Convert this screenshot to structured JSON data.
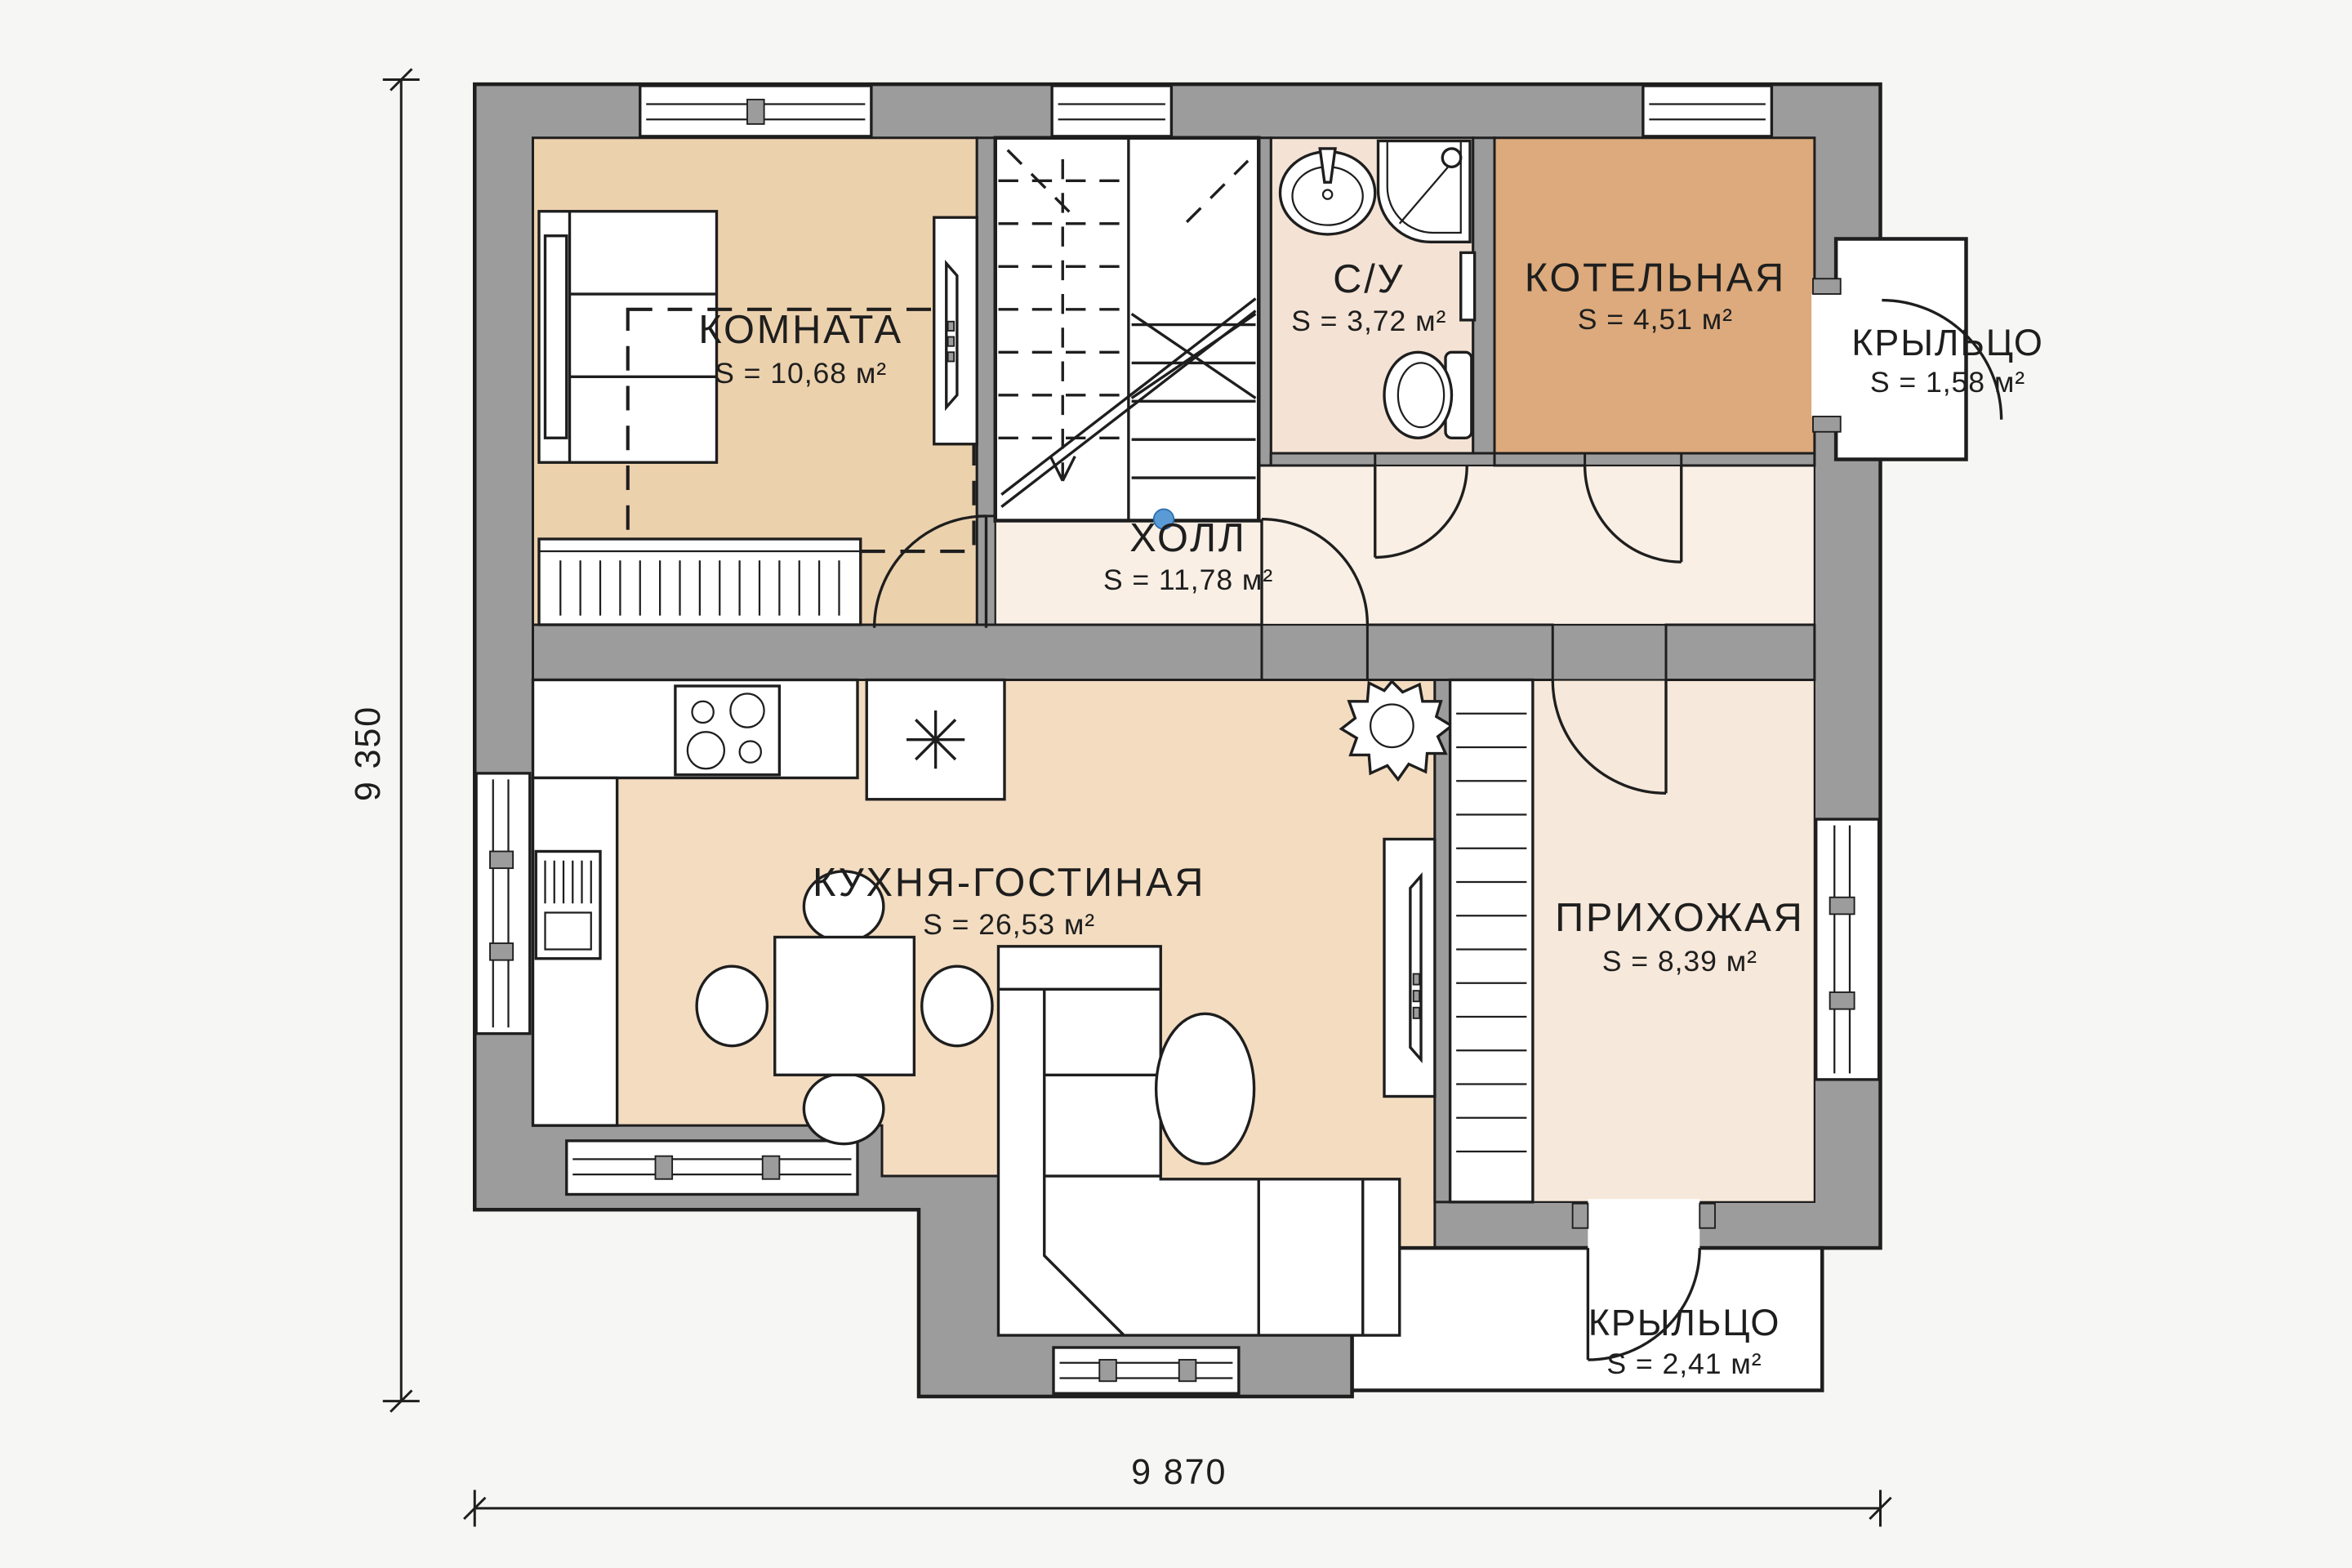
{
  "plan": {
    "rooms": {
      "komnata": {
        "name": "КОМНАТА",
        "area": "S = 10,68 м²"
      },
      "su": {
        "name": "С/У",
        "area": "S = 3,72 м²"
      },
      "kotelnaya": {
        "name": "КОТЕЛЬНАЯ",
        "area": "S = 4,51 м²"
      },
      "kryltso_top": {
        "name": "КРЫЛЬЦО",
        "area": "S = 1,58 м²"
      },
      "holl": {
        "name": "ХОЛЛ",
        "area": "S = 11,78 м²"
      },
      "kuhnya": {
        "name": "КУХНЯ-ГОСТИНАЯ",
        "area": "S = 26,53 м²"
      },
      "prihozhaya": {
        "name": "ПРИХОЖАЯ",
        "area": "S = 8,39 м²"
      },
      "kryltso_bottom": {
        "name": "КРЫЛЬЦО",
        "area": "S = 2,41 м²"
      }
    },
    "dimensions": {
      "height": "9 350",
      "width": "9 870"
    },
    "colors": {
      "bg": "#f6f6f4",
      "wall": "#9c9c9c",
      "line": "#1e1e1e",
      "komnata": "#ecd1ad",
      "kitchen": "#f3dcc0",
      "su": "#f4e3d4",
      "boiler": "#dcaa7c",
      "hall": "#f9efe5",
      "prihozhaya": "#f6e8da",
      "stair_dot": "#5b9bd5"
    }
  }
}
